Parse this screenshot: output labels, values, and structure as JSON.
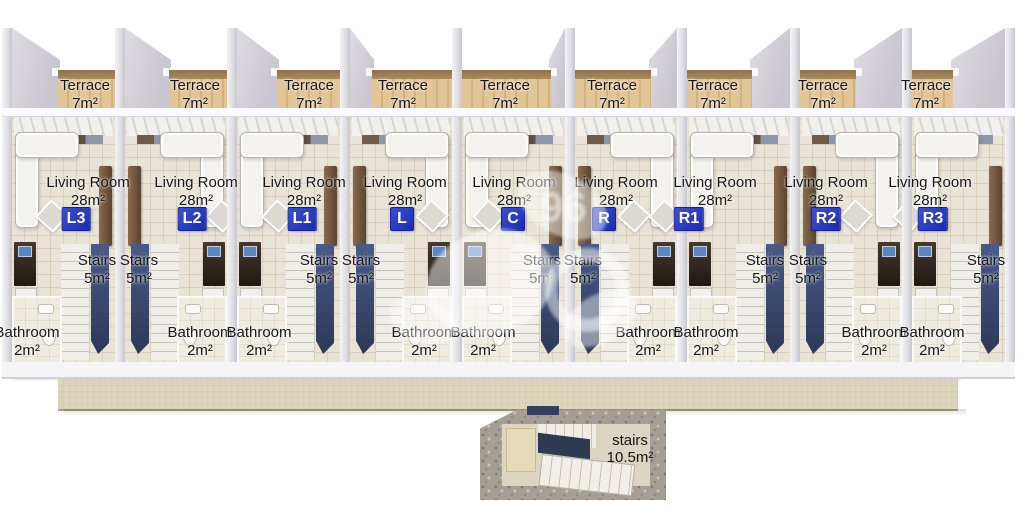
{
  "labels": {
    "terrace": "Terrace",
    "terrace_area": "7m²",
    "living": "Living Room",
    "living_area": "28m²",
    "stairs": "Stairs",
    "stairs_area": "5m²",
    "bathroom": "Bathroom",
    "bathroom_area": "2m²"
  },
  "units": [
    {
      "badge": "L3",
      "variant": "A",
      "x": {
        "terrace": 85,
        "living": 88,
        "badge": 76,
        "stairs": 97,
        "bathroom": 27
      }
    },
    {
      "badge": "L2",
      "variant": "B",
      "x": {
        "terrace": 195,
        "living": 196,
        "badge": 192,
        "stairs": 139,
        "bathroom": 200
      }
    },
    {
      "badge": "L1",
      "variant": "A",
      "x": {
        "terrace": 309,
        "living": 304,
        "badge": 302,
        "stairs": 319,
        "bathroom": 259
      }
    },
    {
      "badge": "L",
      "variant": "B",
      "x": {
        "terrace": 403,
        "living": 405,
        "badge": 402,
        "stairs": 361,
        "bathroom": 424
      }
    },
    {
      "badge": "C",
      "variant": "A",
      "x": {
        "terrace": 505,
        "living": 514,
        "badge": 513,
        "stairs": 542,
        "bathroom": 483
      }
    },
    {
      "badge": "R",
      "variant": "B",
      "x": {
        "terrace": 612,
        "living": 616,
        "badge": 604,
        "stairs": 583,
        "bathroom": 648
      }
    },
    {
      "badge": "R1",
      "variant": "A",
      "x": {
        "terrace": 713,
        "living": 715,
        "badge": 689,
        "stairs": 765,
        "bathroom": 706
      }
    },
    {
      "badge": "R2",
      "variant": "B",
      "x": {
        "terrace": 823,
        "living": 826,
        "badge": 826,
        "stairs": 808,
        "bathroom": 874
      }
    },
    {
      "badge": "R3",
      "variant": "A",
      "x": {
        "terrace": 926,
        "living": 930,
        "badge": 933,
        "stairs": 986,
        "bathroom": 932
      }
    }
  ],
  "basement": {
    "label": "stairs",
    "area": "10.5m²"
  },
  "watermark": "96",
  "colors": {
    "badge_bg": "#2334c2",
    "terrace_wood": "#debf92",
    "living_floor": "#e9e3d6",
    "walkway": "#dcd5bb",
    "stair_void_navy": "#3a4668"
  }
}
